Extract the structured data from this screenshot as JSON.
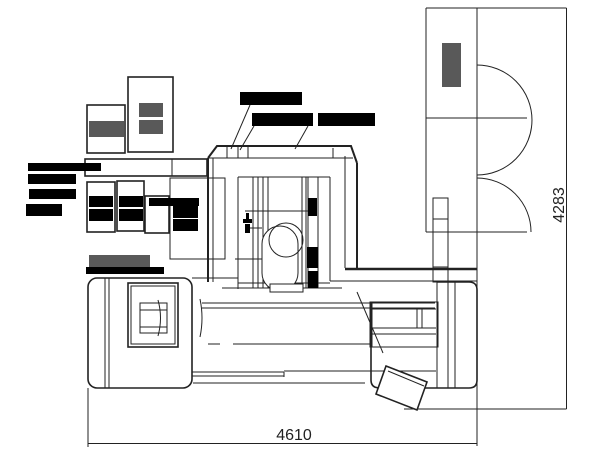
{
  "drawing": {
    "type": "cad-machine-installation-plan",
    "dim_width": "4610",
    "dim_height": "4283"
  },
  "colors": {
    "background": "#ffffff",
    "line": "#222222",
    "gray_fill": "#595959",
    "redaction": "#000000"
  }
}
